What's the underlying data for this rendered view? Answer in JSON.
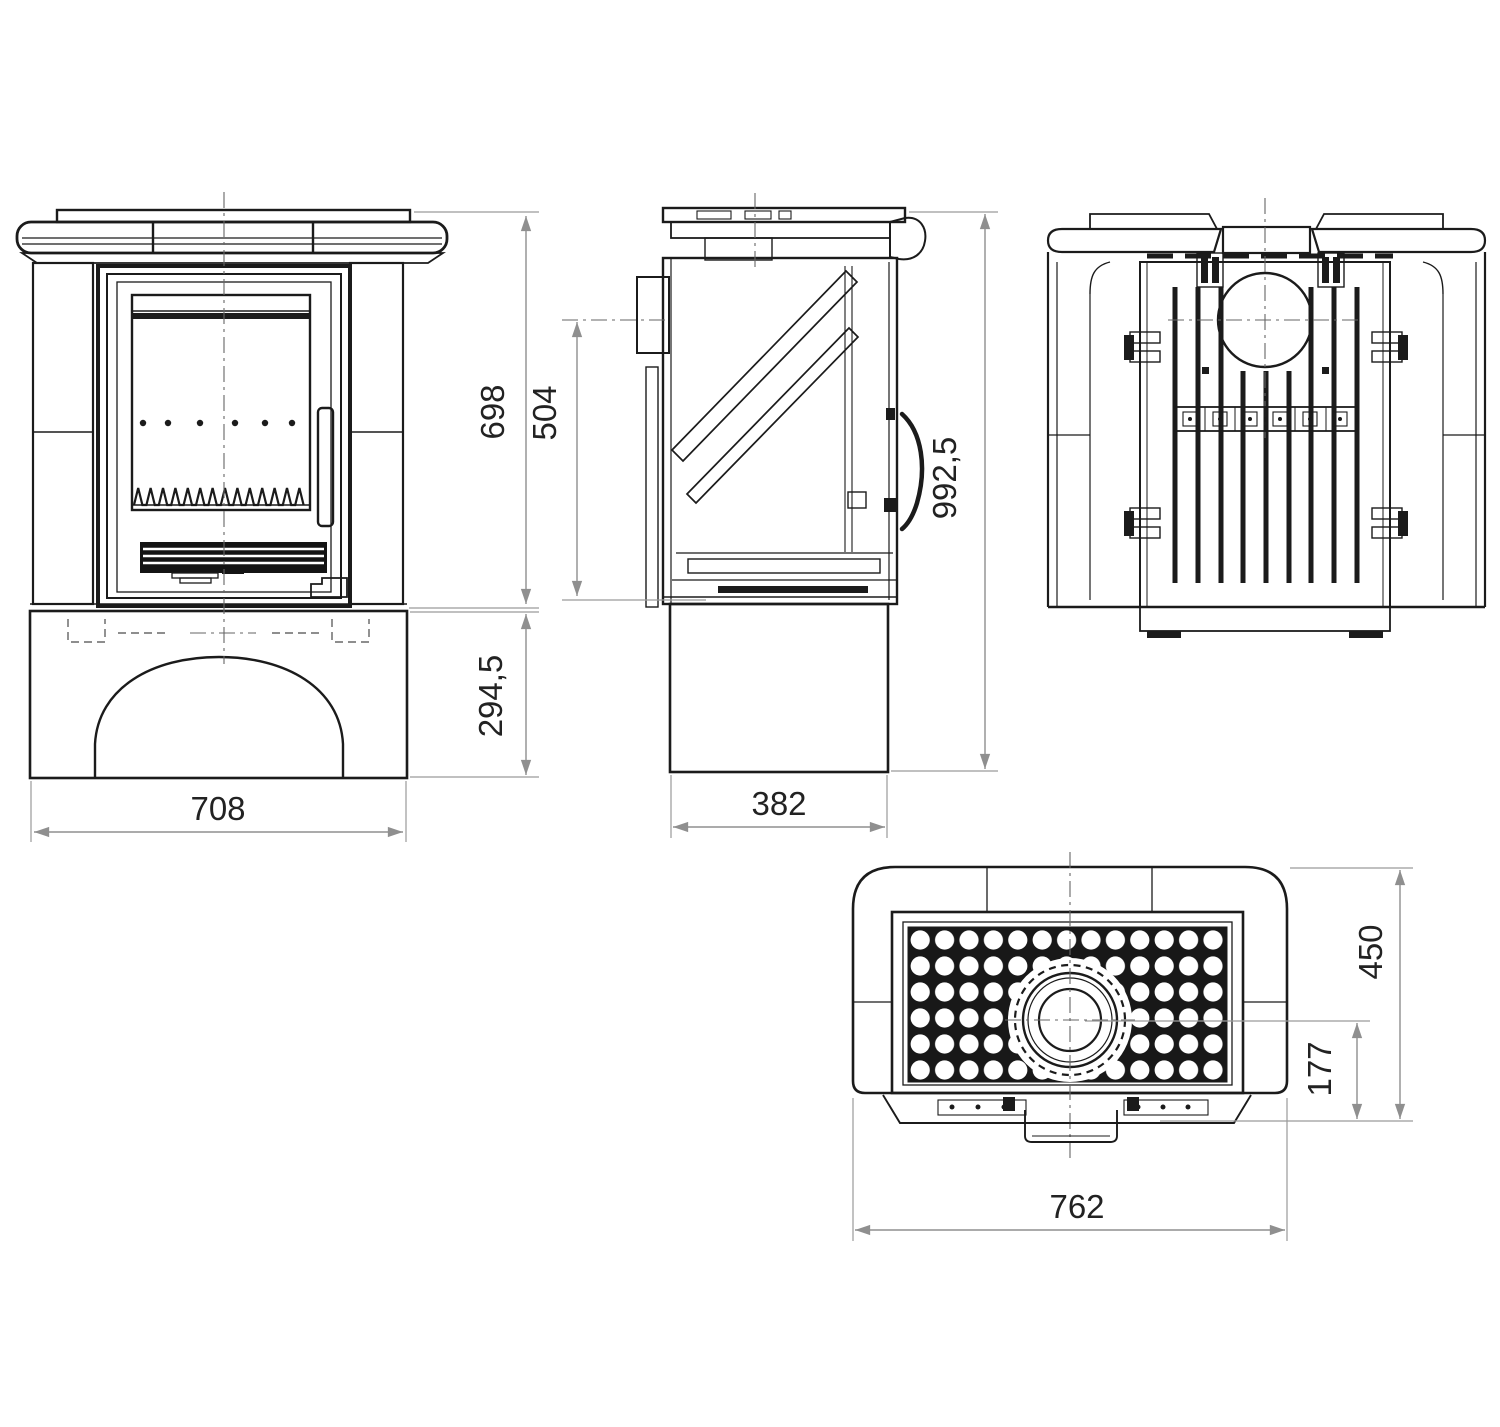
{
  "dimensions": {
    "front": {
      "width": "708",
      "body_height": "698",
      "base_height": "294,5"
    },
    "side": {
      "depth": "382",
      "flue_center_height": "504",
      "total_height": "992,5"
    },
    "top": {
      "width": "762",
      "depth": "450",
      "flue_center_offset": "177"
    }
  },
  "colors": {
    "line": "#1b1b1b",
    "dimension_line": "#8f8f8f",
    "dimension_text": "#222222",
    "background": "#ffffff"
  }
}
